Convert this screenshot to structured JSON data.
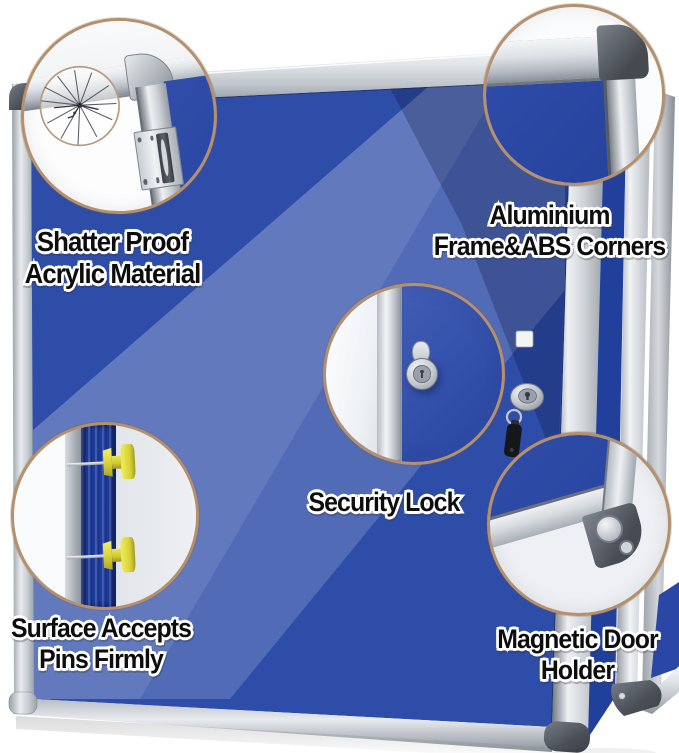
{
  "callouts": {
    "shatterproof": {
      "line1": "Shatter Proof",
      "line2": "Acrylic Material"
    },
    "frame": {
      "line1": "Aluminium",
      "line2": "Frame&ABS Corners"
    },
    "lock": {
      "line1": "Security Lock"
    },
    "pins": {
      "line1": "Surface Accepts",
      "line2": "Pins Firmly"
    },
    "magnet": {
      "line1": "Magnetic Door",
      "line2": "Holder"
    }
  },
  "colors": {
    "background": "#ffffff",
    "felt_blue": "#2e4da8",
    "glare_blue": "#5873c1",
    "frame_silver": "#d6dade",
    "abs_corner_dark": "#4d535a",
    "callout_ring_tan": "#b5906e",
    "pin_yellow": "#ddd83b",
    "key_black": "#15171b"
  }
}
